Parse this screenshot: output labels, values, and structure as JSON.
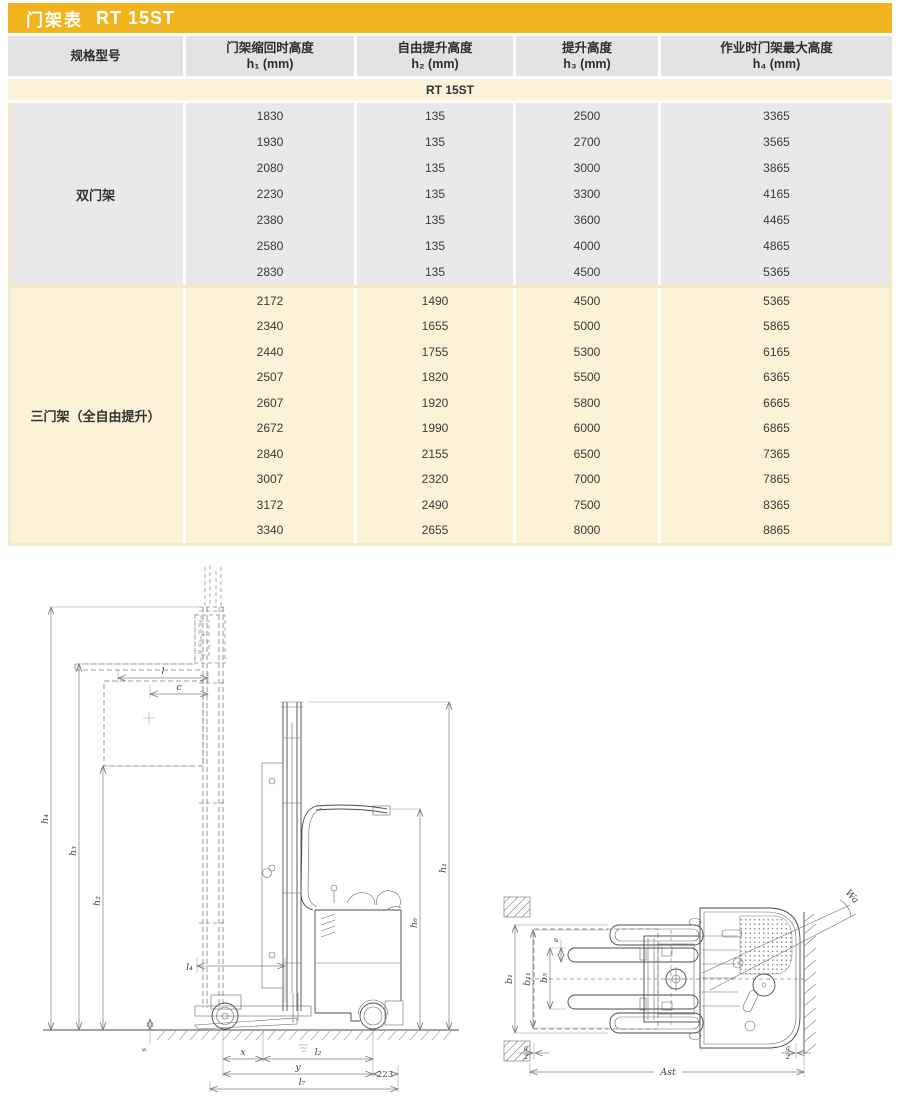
{
  "title": {
    "prefix": "门架表",
    "model": "RT 15ST"
  },
  "table": {
    "headers": [
      {
        "line1": "规格型号",
        "line2": ""
      },
      {
        "line1": "门架缩回时高度",
        "line2": "h₁ (mm)"
      },
      {
        "line1": "自由提升高度",
        "line2": "h₂ (mm)"
      },
      {
        "line1": "提升高度",
        "line2": "h₃ (mm)"
      },
      {
        "line1": "作业时门架最大高度",
        "line2": "h₄ (mm)"
      }
    ],
    "model_row": "RT 15ST",
    "sections": [
      {
        "label": "双门架",
        "rows": [
          [
            "1830",
            "135",
            "2500",
            "3365"
          ],
          [
            "1930",
            "135",
            "2700",
            "3565"
          ],
          [
            "2080",
            "135",
            "3000",
            "3865"
          ],
          [
            "2230",
            "135",
            "3300",
            "4165"
          ],
          [
            "2380",
            "135",
            "3600",
            "4465"
          ],
          [
            "2580",
            "135",
            "4000",
            "4865"
          ],
          [
            "2830",
            "135",
            "4500",
            "5365"
          ]
        ]
      },
      {
        "label": "三门架（全自由提升）",
        "rows": [
          [
            "2172",
            "1490",
            "4500",
            "5365"
          ],
          [
            "2340",
            "1655",
            "5000",
            "5865"
          ],
          [
            "2440",
            "1755",
            "5300",
            "6165"
          ],
          [
            "2507",
            "1820",
            "5500",
            "6365"
          ],
          [
            "2607",
            "1920",
            "5800",
            "6665"
          ],
          [
            "2672",
            "1990",
            "6000",
            "6865"
          ],
          [
            "2840",
            "2155",
            "6500",
            "7365"
          ],
          [
            "3007",
            "2320",
            "7000",
            "7865"
          ],
          [
            "3172",
            "2490",
            "7500",
            "8365"
          ],
          [
            "3340",
            "2655",
            "8000",
            "8865"
          ]
        ]
      }
    ]
  },
  "side_view": {
    "dims": {
      "h4": "h₄",
      "h3": "h₃",
      "h2": "h₂",
      "h1": "h₁",
      "h6": "h₆",
      "l": "l",
      "c": "c",
      "l4": "l₄",
      "s": "s",
      "x": "x",
      "l2": "l₂",
      "y": "y",
      "d223": "223",
      "l7": "l₇"
    }
  },
  "top_view": {
    "dims": {
      "b1": "b₁",
      "b11": "b₁₁",
      "b5": "b₅",
      "e": "e",
      "wa": "Wa",
      "ast": "Ast",
      "a_num": "a",
      "a_den": "2"
    }
  }
}
